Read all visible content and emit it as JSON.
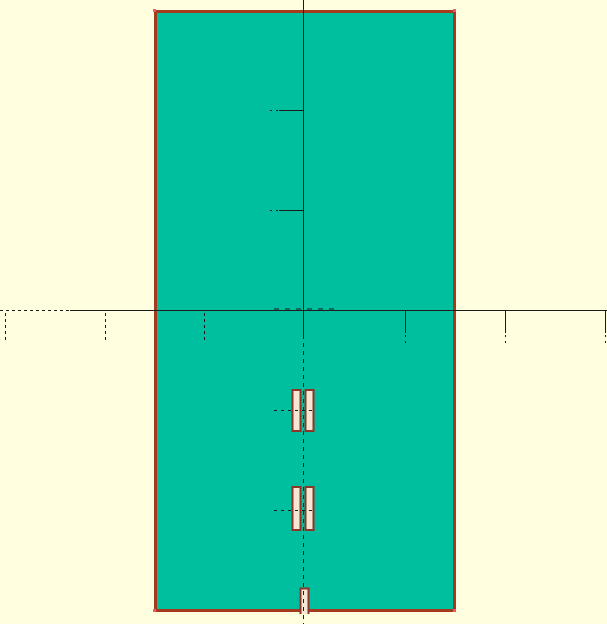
{
  "app": {
    "view_label": "cad-board-canvas"
  },
  "canvas": {
    "width": 607,
    "height": 624,
    "colors": {
      "background": "#FFFFE0",
      "board_fill": "#00BF9E",
      "outline": "#A63A1F",
      "vertex": "#ED5A6E",
      "axis": "#1C1C1C",
      "pad_fill": "#F6E7D5",
      "pad_border": "#8D3526"
    },
    "shapes": [
      {
        "tag": "rect",
        "name": "canvas-background",
        "interactable": true,
        "attrs": {
          "x": 0,
          "y": 0,
          "width": 607,
          "height": 624,
          "fill": "$background"
        }
      },
      {
        "tag": "rect",
        "name": "pcb-board",
        "interactable": true,
        "attrs": {
          "x": 155.5,
          "y": 11.5,
          "width": 299,
          "height": 599,
          "fill": "$board_fill",
          "stroke": "$outline",
          "stroke-width": 3
        }
      },
      {
        "tag": "rect",
        "name": "board-corner-marker",
        "interactable": false,
        "attrs": {
          "x": 153,
          "y": 9,
          "width": 3,
          "height": 3,
          "fill": "$vertex"
        }
      },
      {
        "tag": "rect",
        "name": "board-corner-marker",
        "interactable": false,
        "attrs": {
          "x": 453,
          "y": 9,
          "width": 3,
          "height": 3,
          "fill": "$vertex"
        }
      },
      {
        "tag": "rect",
        "name": "board-corner-marker",
        "interactable": false,
        "attrs": {
          "x": 153,
          "y": 609,
          "width": 3,
          "height": 3,
          "fill": "$vertex"
        }
      },
      {
        "tag": "rect",
        "name": "board-corner-marker",
        "interactable": false,
        "attrs": {
          "x": 453,
          "y": 609,
          "width": 3,
          "height": 3,
          "fill": "$vertex"
        }
      },
      {
        "tag": "path",
        "name": "edge-notch-pad",
        "interactable": true,
        "attrs": {
          "d": "M 300.5 614 L 300.5 588.5 L 308.5 588.5 L 308.5 614",
          "fill": "$pad_fill",
          "stroke": "$pad_border",
          "stroke-width": 2,
          "stroke-linejoin": "miter"
        }
      },
      {
        "tag": "line",
        "name": "x-axis-dashed-segment",
        "interactable": false,
        "attrs": {
          "x1": 0,
          "y1": 310.5,
          "x2": 70,
          "y2": 310.5,
          "stroke": "$axis",
          "stroke-width": 1,
          "stroke-dasharray": "3,3"
        }
      },
      {
        "tag": "line",
        "name": "x-axis-line",
        "interactable": false,
        "attrs": {
          "x1": 70,
          "y1": 310.5,
          "x2": 607,
          "y2": 310.5,
          "stroke": "$axis",
          "stroke-width": 1
        }
      },
      {
        "tag": "line",
        "name": "y-axis-line",
        "interactable": false,
        "attrs": {
          "x1": 303.5,
          "y1": 0,
          "x2": 303.5,
          "y2": 335,
          "stroke": "$axis",
          "stroke-width": 1
        }
      },
      {
        "tag": "line",
        "name": "vertical-centerline",
        "interactable": false,
        "attrs": {
          "x1": 303.5,
          "y1": 335,
          "x2": 303.5,
          "y2": 624,
          "stroke": "$axis",
          "stroke-width": 1,
          "stroke-dasharray": "4,4"
        }
      },
      {
        "tag": "line",
        "name": "origin-crosshair-dashes",
        "interactable": false,
        "attrs": {
          "x1": 274,
          "y1": 309,
          "x2": 334,
          "y2": 309,
          "stroke": "$axis",
          "stroke-width": 1,
          "stroke-dasharray": "5,6"
        }
      },
      {
        "tag": "line",
        "name": "x-axis-tick-dashed",
        "interactable": false,
        "attrs": {
          "x1": 5.5,
          "y1": 313,
          "x2": 5.5,
          "y2": 343,
          "stroke": "$axis",
          "stroke-width": 1,
          "stroke-dasharray": "3,3"
        }
      },
      {
        "tag": "line",
        "name": "x-axis-tick-dashed",
        "interactable": false,
        "attrs": {
          "x1": 105.5,
          "y1": 313,
          "x2": 105.5,
          "y2": 343,
          "stroke": "$axis",
          "stroke-width": 1,
          "stroke-dasharray": "3,3"
        }
      },
      {
        "tag": "line",
        "name": "x-axis-tick-dashed",
        "interactable": false,
        "attrs": {
          "x1": 204.5,
          "y1": 313,
          "x2": 204.5,
          "y2": 343,
          "stroke": "$axis",
          "stroke-width": 1,
          "stroke-dasharray": "3,3"
        }
      },
      {
        "tag": "line",
        "name": "x-axis-tick",
        "interactable": false,
        "attrs": {
          "x1": 405.5,
          "y1": 311,
          "x2": 405.5,
          "y2": 333,
          "stroke": "$axis",
          "stroke-width": 1
        }
      },
      {
        "tag": "line",
        "name": "x-axis-tick",
        "interactable": false,
        "attrs": {
          "x1": 505.5,
          "y1": 311,
          "x2": 505.5,
          "y2": 333,
          "stroke": "$axis",
          "stroke-width": 1
        }
      },
      {
        "tag": "line",
        "name": "x-axis-tick",
        "interactable": false,
        "attrs": {
          "x1": 605.5,
          "y1": 311,
          "x2": 605.5,
          "y2": 333,
          "stroke": "$axis",
          "stroke-width": 1
        }
      },
      {
        "tag": "line",
        "name": "x-axis-tick-tip",
        "interactable": false,
        "attrs": {
          "x1": 405.5,
          "y1": 335,
          "x2": 405.5,
          "y2": 345,
          "stroke": "$axis",
          "stroke-width": 1,
          "stroke-dasharray": "2,4"
        }
      },
      {
        "tag": "line",
        "name": "x-axis-tick-tip",
        "interactable": false,
        "attrs": {
          "x1": 505.5,
          "y1": 335,
          "x2": 505.5,
          "y2": 345,
          "stroke": "$axis",
          "stroke-width": 1,
          "stroke-dasharray": "2,4"
        }
      },
      {
        "tag": "line",
        "name": "x-axis-tick-tip",
        "interactable": false,
        "attrs": {
          "x1": 605.5,
          "y1": 335,
          "x2": 605.5,
          "y2": 345,
          "stroke": "$axis",
          "stroke-width": 1,
          "stroke-dasharray": "2,4"
        }
      },
      {
        "tag": "line",
        "name": "y-axis-tick",
        "interactable": false,
        "attrs": {
          "x1": 279,
          "y1": 110.5,
          "x2": 303.5,
          "y2": 110.5,
          "stroke": "$axis",
          "stroke-width": 1
        }
      },
      {
        "tag": "line",
        "name": "y-axis-tick",
        "interactable": false,
        "attrs": {
          "x1": 279,
          "y1": 210.5,
          "x2": 303.5,
          "y2": 210.5,
          "stroke": "$axis",
          "stroke-width": 1
        }
      },
      {
        "tag": "line",
        "name": "y-axis-tick-tip",
        "interactable": false,
        "attrs": {
          "x1": 270,
          "y1": 110.5,
          "x2": 279,
          "y2": 110.5,
          "stroke": "$axis",
          "stroke-width": 1,
          "stroke-dasharray": "2,4"
        }
      },
      {
        "tag": "line",
        "name": "y-axis-tick-tip",
        "interactable": false,
        "attrs": {
          "x1": 270,
          "y1": 210.5,
          "x2": 279,
          "y2": 210.5,
          "stroke": "$axis",
          "stroke-width": 1,
          "stroke-dasharray": "2,4"
        }
      },
      {
        "tag": "rect",
        "name": "smd-pad",
        "interactable": true,
        "attrs": {
          "x": 292.5,
          "y": 390,
          "width": 8,
          "height": 41,
          "fill": "$pad_fill",
          "stroke": "$pad_border",
          "stroke-width": 2
        }
      },
      {
        "tag": "rect",
        "name": "smd-pad",
        "interactable": true,
        "attrs": {
          "x": 305.5,
          "y": 390,
          "width": 8,
          "height": 41,
          "fill": "$pad_fill",
          "stroke": "$pad_border",
          "stroke-width": 2
        }
      },
      {
        "tag": "rect",
        "name": "smd-pad",
        "interactable": true,
        "attrs": {
          "x": 292.5,
          "y": 487,
          "width": 8,
          "height": 43,
          "fill": "$pad_fill",
          "stroke": "$pad_border",
          "stroke-width": 2
        }
      },
      {
        "tag": "rect",
        "name": "smd-pad",
        "interactable": true,
        "attrs": {
          "x": 305.5,
          "y": 487,
          "width": 8,
          "height": 43,
          "fill": "$pad_fill",
          "stroke": "$pad_border",
          "stroke-width": 2
        }
      },
      {
        "tag": "line",
        "name": "pad-centerline-tick",
        "interactable": false,
        "attrs": {
          "x1": 274,
          "y1": 410.5,
          "x2": 316,
          "y2": 410.5,
          "stroke": "$axis",
          "stroke-width": 1,
          "stroke-dasharray": "3,4"
        }
      },
      {
        "tag": "line",
        "name": "pad-centerline-tick",
        "interactable": false,
        "attrs": {
          "x1": 274,
          "y1": 510.5,
          "x2": 316,
          "y2": 510.5,
          "stroke": "$axis",
          "stroke-width": 1,
          "stroke-dasharray": "3,4"
        }
      }
    ]
  }
}
